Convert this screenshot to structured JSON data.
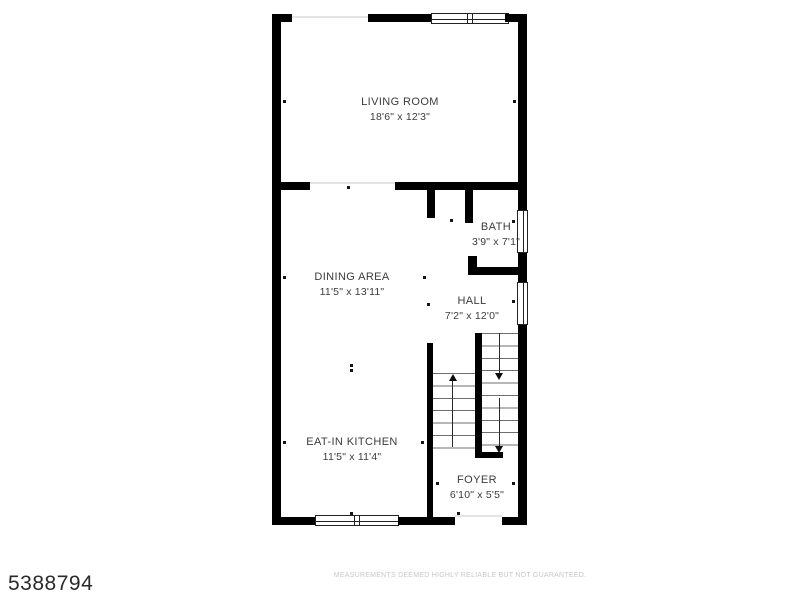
{
  "floorplan": {
    "rooms": [
      {
        "name": "LIVING ROOM",
        "dims": "18'6\" x 12'3\""
      },
      {
        "name": "BATH",
        "dims": "3'9\" x 7'1\""
      },
      {
        "name": "DINING AREA",
        "dims": "11'5\" x 13'11\""
      },
      {
        "name": "HALL",
        "dims": "7'2\" x 12'0\""
      },
      {
        "name": "EAT-IN KITCHEN",
        "dims": "11'5\" x 11'4\""
      },
      {
        "name": "FOYER",
        "dims": "6'10\" x 5'5\""
      }
    ],
    "features": {
      "stairs_up": "stairs going up",
      "stairs_down": "stairs going down",
      "windows": 5,
      "front_door_opening": "bottom right"
    }
  },
  "footer": {
    "mls_number": "5388794",
    "disclaimer": "MEASUREMENTS DEEMED HIGHLY RELIABLE BUT NOT GUARANTEED."
  },
  "colors": {
    "wall": "#000000",
    "label_text": "#3c3c3c",
    "disclaimer_text": "#c7c7c7",
    "background": "#ffffff"
  }
}
